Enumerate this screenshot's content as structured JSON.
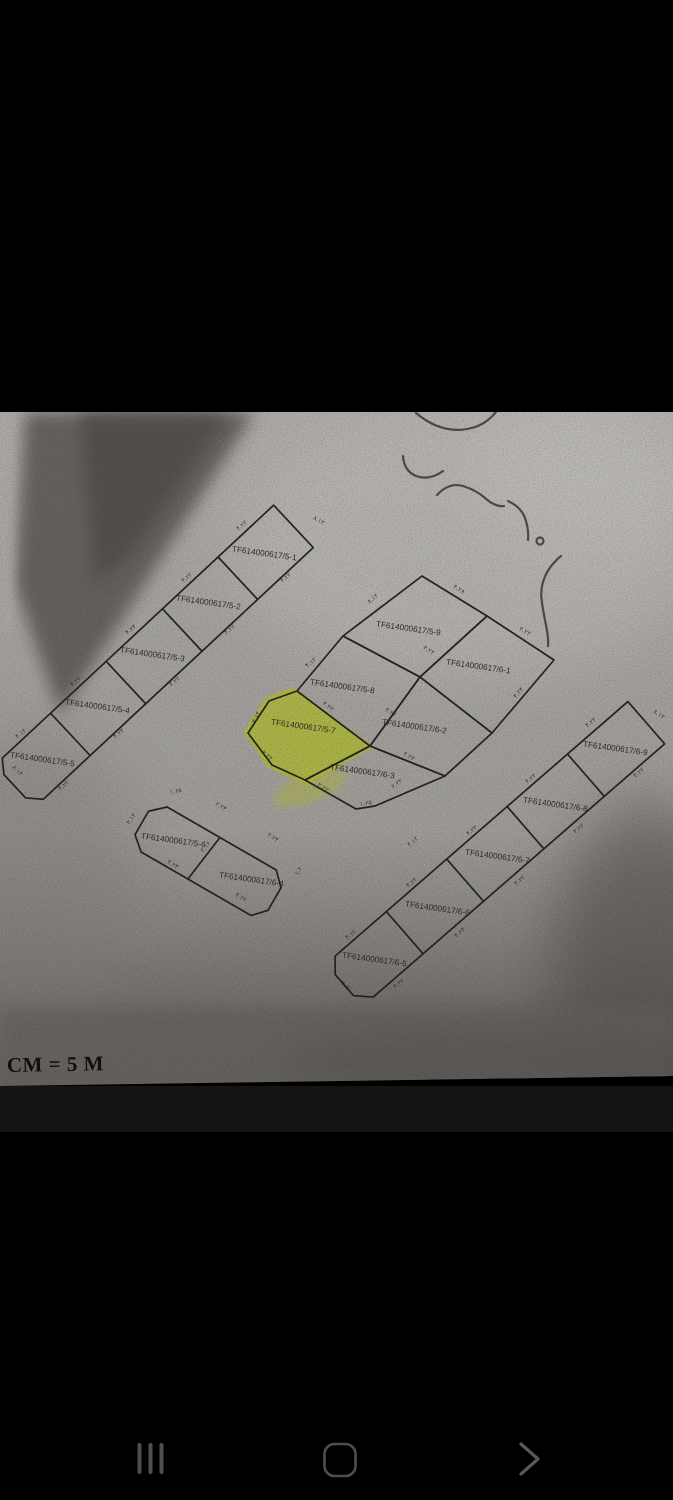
{
  "device": {
    "background": "#000000"
  },
  "photo": {
    "type": "scanned cadastral subdivision plan photographed on phone",
    "paper_color": "#cbc7c2",
    "line_color": "#2f2d2a",
    "scale_text": "CM = 5 M",
    "handwritten_note": "۲۰ متری",
    "highlight": {
      "parcel": "TF614000617/5-7",
      "color": "#d9e53c"
    }
  },
  "parcels": [
    {
      "id": "TF614000617/5-1"
    },
    {
      "id": "TF614000617/5-2"
    },
    {
      "id": "TF614000617/5-3"
    },
    {
      "id": "TF614000617/5-4"
    },
    {
      "id": "TF614000617/5-5"
    },
    {
      "id": "TF614000617/5-6"
    },
    {
      "id": "TF614000617/5-7",
      "highlighted": true
    },
    {
      "id": "TF614000617/5-8"
    },
    {
      "id": "TF614000617/5-9"
    },
    {
      "id": "TF614000617/6-1"
    },
    {
      "id": "TF614000617/6-2"
    },
    {
      "id": "TF614000617/6-3"
    },
    {
      "id": "TF614000617/6-4"
    },
    {
      "id": "TF614000617/6-5"
    },
    {
      "id": "TF614000617/6-6"
    },
    {
      "id": "TF614000617/6-7"
    },
    {
      "id": "TF614000617/6-8"
    },
    {
      "id": "TF614000617/6-9"
    }
  ],
  "dims": [
    "۴.۲۲",
    "۴.۲۲",
    "۴.۲۴",
    "۴.۲۲",
    "۴.۱۲",
    "۴.۲۲",
    "۴.۲۲",
    "۴.۲۲",
    "۴.۲۴",
    "۴.۲۲",
    "۸.۱۲",
    "۸.۱۴",
    "۴.۲۸",
    "۴.۲۲",
    "۸.۱۲",
    "۴.۲۲",
    "۴.۱۲",
    "۴.۲۲",
    "۴.۲۴",
    "۳.۱۴",
    "۲.۲۴",
    "۲.۲۲",
    "۱.۶۵",
    "۲.۲۲",
    "۴.۲۲",
    "۴.۲۲",
    "۴.۲۲",
    "۴.۲۴",
    "۴.۲۲",
    "۴.۱۲",
    "۴.۲۲",
    "۴.۲۲",
    "۴.۲۲",
    "۴.۲۴",
    "۴.۲۲",
    "۸.۱۲",
    "۴.۵۱",
    "۱.۶۵",
    "۲.۲۴",
    "۲.۲۴",
    "۳.۱۴",
    "۴.۲۴",
    "۴.۲۲",
    "۲.۱۶",
    "۱.۶",
    "۴.۲۲",
    "۴.۱۲"
  ],
  "nav_bar": {
    "color": "#4b4f53",
    "buttons": [
      {
        "name": "recents"
      },
      {
        "name": "home"
      },
      {
        "name": "back"
      }
    ]
  }
}
